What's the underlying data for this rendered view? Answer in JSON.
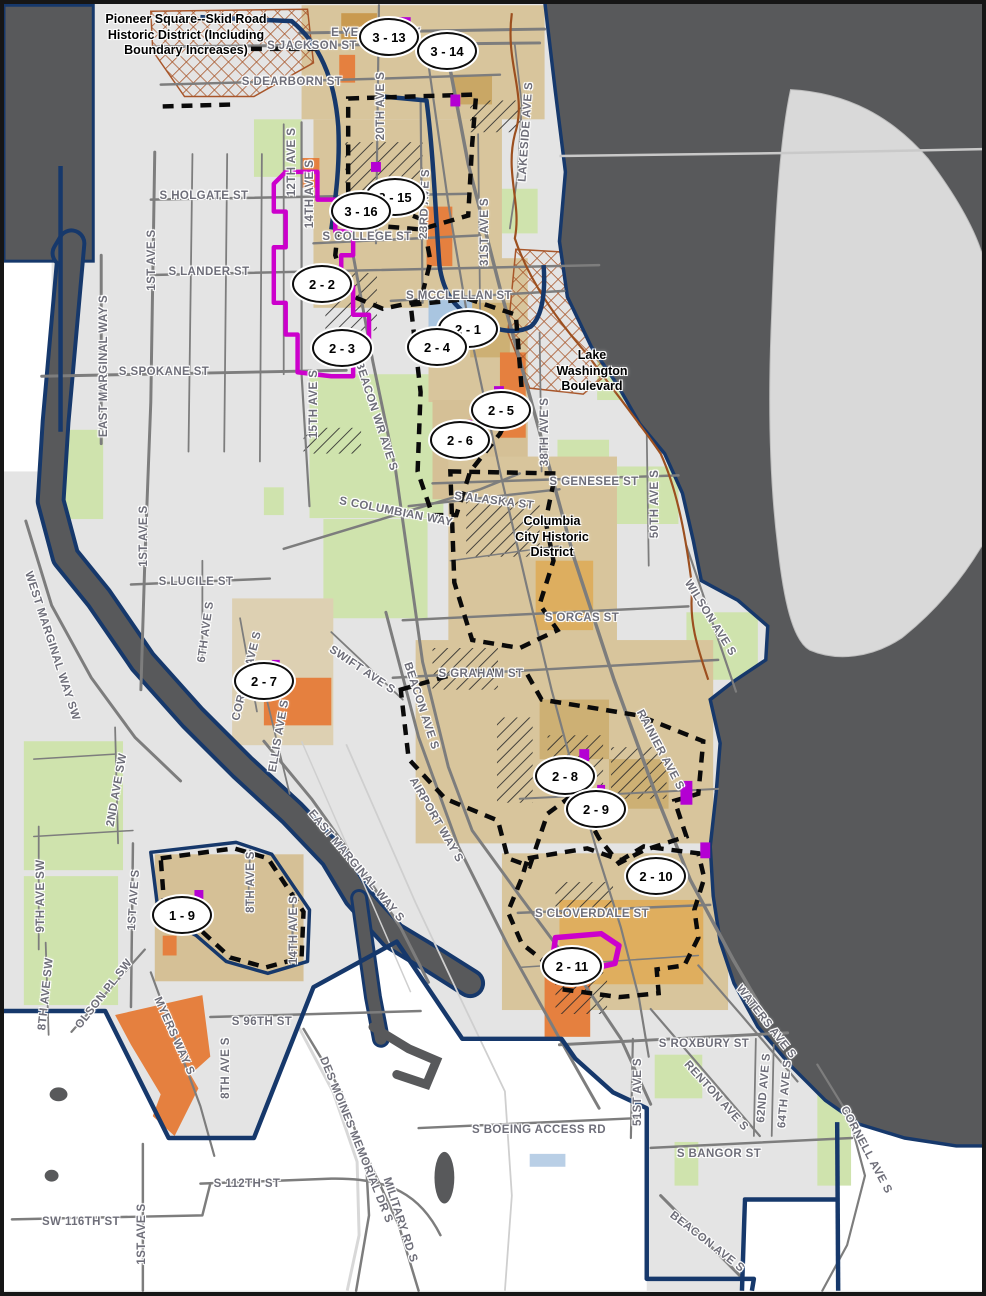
{
  "map": {
    "title": "Seattle historic districts and urban villages map (south Seattle)",
    "colors": {
      "water": "#58595b",
      "land_city": "#e4e4e4",
      "land_outside": "#ffffff",
      "mercer_island": "#d9d9d9",
      "city_boundary": "#16386b",
      "road": "#7d7d7d",
      "street_label": "#6e6e79",
      "park_green": "#cfe3ad",
      "village_tan": "#d8c59c",
      "village_gold": "#dfae5e",
      "orange_area": "#e5803f",
      "historic_magenta": "#cc00cc",
      "hatch_black": "#2a2a2a",
      "crosshatch_sienna": "#a8562a",
      "district_dash": "#0a0a0a",
      "boulevard_brown": "#9c4f1f",
      "blue_patch": "#a9c5e0"
    },
    "annotations": {
      "pioneer_square": {
        "text": "Pioneer Square--Skid Road\nHistoric District (Including\nBoundary Increases)",
        "x": 182,
        "y": 8
      },
      "lake_washington_blvd": {
        "text": "Lake\nWashington\nBoulevard",
        "x": 588,
        "y": 344
      },
      "columbia_city": {
        "text": "Columbia\nCity Historic\nDistrict",
        "x": 548,
        "y": 510
      }
    },
    "markers": [
      {
        "label": "3 - 13",
        "x": 385,
        "y": 33
      },
      {
        "label": "3 - 14",
        "x": 443,
        "y": 47
      },
      {
        "label": "3 - 15",
        "x": 391,
        "y": 193
      },
      {
        "label": "3 - 16",
        "x": 357,
        "y": 207
      },
      {
        "label": "2 - 2",
        "x": 318,
        "y": 280
      },
      {
        "label": "2 - 3",
        "x": 338,
        "y": 344
      },
      {
        "label": "2 - 1",
        "x": 464,
        "y": 325
      },
      {
        "label": "2 - 4",
        "x": 433,
        "y": 343
      },
      {
        "label": "2 - 5",
        "x": 497,
        "y": 406
      },
      {
        "label": "2 - 6",
        "x": 456,
        "y": 436
      },
      {
        "label": "2 - 7",
        "x": 260,
        "y": 677
      },
      {
        "label": "2 - 8",
        "x": 561,
        "y": 772
      },
      {
        "label": "2 - 9",
        "x": 592,
        "y": 805
      },
      {
        "label": "2 - 10",
        "x": 652,
        "y": 872
      },
      {
        "label": "2 - 11",
        "x": 568,
        "y": 962
      },
      {
        "label": "1 - 9",
        "x": 178,
        "y": 911
      }
    ],
    "street_labels": [
      {
        "text": "E YESLER WAY",
        "x": 372,
        "y": 29,
        "rotate": 0
      },
      {
        "text": "S JACKSON ST",
        "x": 308,
        "y": 42,
        "rotate": 0
      },
      {
        "text": "S DEARBORN ST",
        "x": 288,
        "y": 78,
        "rotate": 0
      },
      {
        "text": "20TH AVE S",
        "x": 377,
        "y": 102,
        "rotate": -90
      },
      {
        "text": "12TH AVE S",
        "x": 288,
        "y": 158,
        "rotate": -90
      },
      {
        "text": "14TH AVE S",
        "x": 306,
        "y": 190,
        "rotate": -90
      },
      {
        "text": "S HOLGATE ST",
        "x": 200,
        "y": 192,
        "rotate": 0
      },
      {
        "text": "S COLLEGE ST",
        "x": 363,
        "y": 233,
        "rotate": 0
      },
      {
        "text": "23RD AVE S",
        "x": 421,
        "y": 200,
        "rotate": -88
      },
      {
        "text": "31ST AVE S",
        "x": 481,
        "y": 228,
        "rotate": -90
      },
      {
        "text": "LAKESIDE AVE S",
        "x": 522,
        "y": 128,
        "rotate": -86
      },
      {
        "text": "1ST AVE S",
        "x": 148,
        "y": 256,
        "rotate": -90
      },
      {
        "text": "S LANDER ST",
        "x": 205,
        "y": 268,
        "rotate": 0
      },
      {
        "text": "S MCCLELLAN ST",
        "x": 455,
        "y": 292,
        "rotate": 0
      },
      {
        "text": "S SPOKANE ST",
        "x": 160,
        "y": 368,
        "rotate": 0
      },
      {
        "text": "EAST MARGINAL WAY S",
        "x": 100,
        "y": 362,
        "rotate": -90
      },
      {
        "text": "15TH AVE S",
        "x": 310,
        "y": 400,
        "rotate": -90
      },
      {
        "text": "BEACON WR AVE S",
        "x": 372,
        "y": 412,
        "rotate": 72
      },
      {
        "text": "38TH AVE S",
        "x": 541,
        "y": 428,
        "rotate": -90
      },
      {
        "text": "S GENESEE ST",
        "x": 590,
        "y": 478,
        "rotate": 0
      },
      {
        "text": "S ALASKA ST",
        "x": 490,
        "y": 497,
        "rotate": 7
      },
      {
        "text": "50TH AVE S",
        "x": 651,
        "y": 500,
        "rotate": -90
      },
      {
        "text": "S COLUMBIAN WAY",
        "x": 392,
        "y": 508,
        "rotate": 11
      },
      {
        "text": "WILSON AVE S",
        "x": 706,
        "y": 614,
        "rotate": 58
      },
      {
        "text": "1ST AVE S",
        "x": 140,
        "y": 532,
        "rotate": -90
      },
      {
        "text": "S LUCILE ST",
        "x": 192,
        "y": 578,
        "rotate": 0
      },
      {
        "text": "WEST MARGINAL WAY SW",
        "x": 48,
        "y": 642,
        "rotate": 72
      },
      {
        "text": "6TH AVE S",
        "x": 202,
        "y": 628,
        "rotate": -82
      },
      {
        "text": "S ORCAS ST",
        "x": 578,
        "y": 614,
        "rotate": 0
      },
      {
        "text": "CORSON AVE S",
        "x": 243,
        "y": 672,
        "rotate": -76
      },
      {
        "text": "SWIFT AVE S",
        "x": 358,
        "y": 666,
        "rotate": 34
      },
      {
        "text": "ELLIS AVE S",
        "x": 275,
        "y": 732,
        "rotate": -80
      },
      {
        "text": "S GRAHAM ST",
        "x": 477,
        "y": 670,
        "rotate": 0
      },
      {
        "text": "BEACON AVE S",
        "x": 417,
        "y": 702,
        "rotate": 72
      },
      {
        "text": "RAINIER AVE S",
        "x": 656,
        "y": 746,
        "rotate": 62
      },
      {
        "text": "AIRPORT WAY S",
        "x": 432,
        "y": 816,
        "rotate": 60
      },
      {
        "text": "EAST MARGINAL WAY S",
        "x": 352,
        "y": 862,
        "rotate": 50
      },
      {
        "text": "2ND AVE SW",
        "x": 113,
        "y": 786,
        "rotate": -80
      },
      {
        "text": "9TH AVE SW",
        "x": 37,
        "y": 892,
        "rotate": -90
      },
      {
        "text": "8TH AVE SW",
        "x": 42,
        "y": 990,
        "rotate": -84
      },
      {
        "text": "1ST AVE S",
        "x": 130,
        "y": 896,
        "rotate": -86
      },
      {
        "text": "8TH AVE S",
        "x": 247,
        "y": 878,
        "rotate": -90
      },
      {
        "text": "14TH AVE S",
        "x": 290,
        "y": 926,
        "rotate": -90
      },
      {
        "text": "OLSON PL SW",
        "x": 100,
        "y": 990,
        "rotate": -52
      },
      {
        "text": "MYERS WAY S",
        "x": 170,
        "y": 1032,
        "rotate": 66
      },
      {
        "text": "S CLOVERDALE ST",
        "x": 588,
        "y": 910,
        "rotate": 0
      },
      {
        "text": "WATERS AVE S",
        "x": 762,
        "y": 1018,
        "rotate": 52
      },
      {
        "text": "S 96TH ST",
        "x": 258,
        "y": 1018,
        "rotate": 0
      },
      {
        "text": "S ROXBURY ST",
        "x": 700,
        "y": 1040,
        "rotate": 0
      },
      {
        "text": "RENTON AVE S",
        "x": 712,
        "y": 1092,
        "rotate": 48
      },
      {
        "text": "62ND AVE S",
        "x": 760,
        "y": 1084,
        "rotate": -85
      },
      {
        "text": "64TH AVE S",
        "x": 781,
        "y": 1090,
        "rotate": -85
      },
      {
        "text": "8TH AVE S",
        "x": 222,
        "y": 1064,
        "rotate": -90
      },
      {
        "text": "DES MOINES MEMORIAL DR S",
        "x": 352,
        "y": 1136,
        "rotate": 68
      },
      {
        "text": "MILITARY RD S",
        "x": 396,
        "y": 1216,
        "rotate": 72
      },
      {
        "text": "S BOEING ACCESS RD",
        "x": 535,
        "y": 1126,
        "rotate": 0
      },
      {
        "text": "51ST AVE S",
        "x": 634,
        "y": 1088,
        "rotate": -90
      },
      {
        "text": "S BANGOR ST",
        "x": 715,
        "y": 1150,
        "rotate": 0
      },
      {
        "text": "BEACON AVE S",
        "x": 703,
        "y": 1238,
        "rotate": 38
      },
      {
        "text": "CORNELL AVE S",
        "x": 862,
        "y": 1146,
        "rotate": 62
      },
      {
        "text": "S 112TH ST",
        "x": 243,
        "y": 1180,
        "rotate": 0
      },
      {
        "text": "SW 116TH ST",
        "x": 77,
        "y": 1218,
        "rotate": 0
      },
      {
        "text": "1ST AVE S",
        "x": 138,
        "y": 1230,
        "rotate": -90
      }
    ]
  }
}
